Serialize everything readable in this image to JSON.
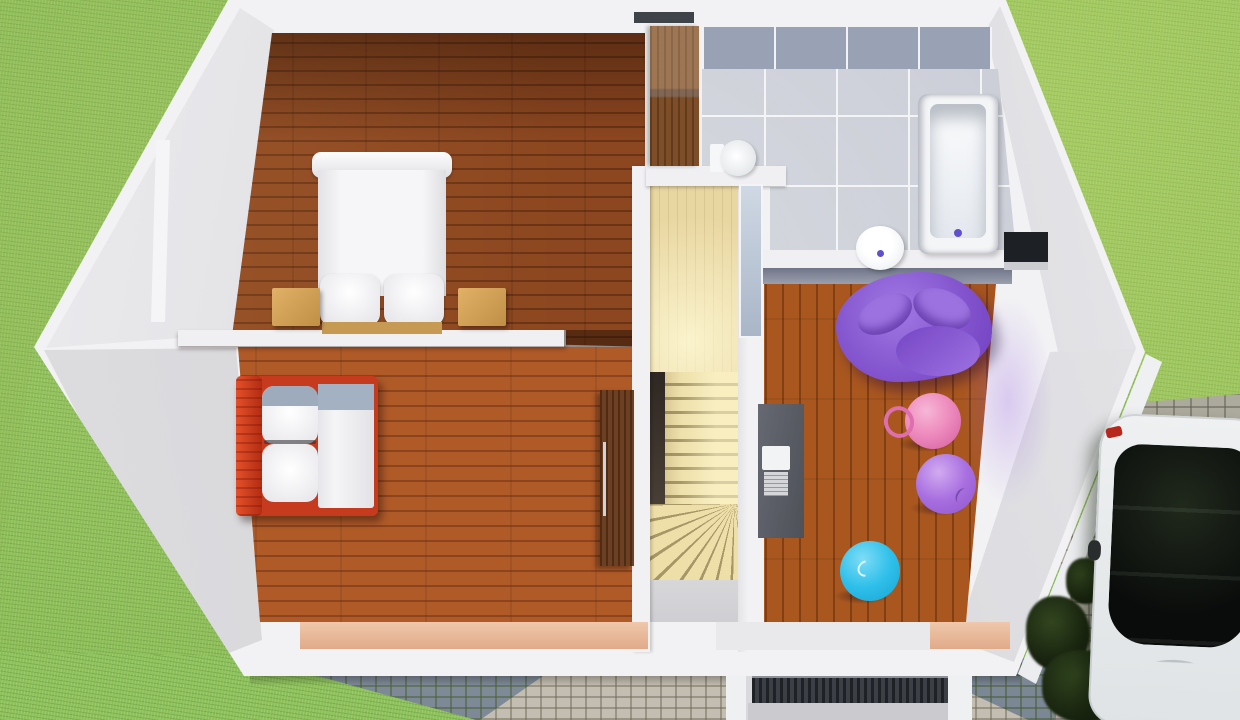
{
  "scene": {
    "title": "3D floor plan render, upper floor, top-down view",
    "rooms": [
      {
        "name": "Master bedroom",
        "position": "top-left",
        "floor": "dark wood planks",
        "furniture": [
          "double bed with white duvet and two pillows",
          "left nightstand",
          "right nightstand"
        ]
      },
      {
        "name": "Bathroom",
        "position": "top-right",
        "floor": "grey tiles with white grout",
        "furniture": [
          "bathtub",
          "pedestal basin",
          "toilet"
        ]
      },
      {
        "name": "Second bedroom",
        "position": "bottom-left",
        "floor": "orange wood planks",
        "furniture": [
          "single bed with red frame and grey-white bedding",
          "tall wooden cabinet"
        ]
      },
      {
        "name": "Playroom",
        "position": "right",
        "floor": "orange wood planks",
        "furniture": [
          "purple bean bag",
          "pink hopper ball with handle",
          "lilac gym ball",
          "blue gym ball",
          "grey desk with laptop"
        ]
      },
      {
        "name": "Stair hall",
        "position": "center",
        "floor": "pale wood",
        "furniture": [
          "straight stair flight",
          "winder steps",
          "glass partition",
          "wardrobe"
        ]
      }
    ],
    "environment": {
      "lawn": "green grass surrounding the house",
      "stone_path": "blue-grey cobblestones with light stone walkway, bottom",
      "driveway": "light grey cobblestone, right side",
      "car": "white car with black glass roof parked on driveway",
      "shrubs": "dark green bushes beside driveway",
      "entrance": "door grate / doormat at bottom-center porch"
    },
    "colors": {
      "grass": "#8abc58",
      "house_wall": "#f2f2f4",
      "gable_face": "#d3d3d7",
      "master_floor": "#8d4720",
      "bedroom2_floor": "#b05a28",
      "playroom_floor": "#a9571f",
      "hall_floor": "#e9d7a2",
      "bath_tile": "#cacdd6",
      "bath_tile_band": "#99a2b4",
      "bed2_frame_red": "#c63a1d",
      "bean_bag_purple": "#8152cc",
      "ball_pink": "#ee8cbe",
      "ball_lilac": "#a86fe0",
      "ball_blue": "#2fc0ea",
      "desk_grey": "#55585f",
      "car_body": "#eceff0",
      "car_glass": "#0b0d0e",
      "cobble_blue": "#7b8795",
      "cobble_light": "#c3beb1",
      "driveway_stone": "#b2aea5"
    }
  }
}
